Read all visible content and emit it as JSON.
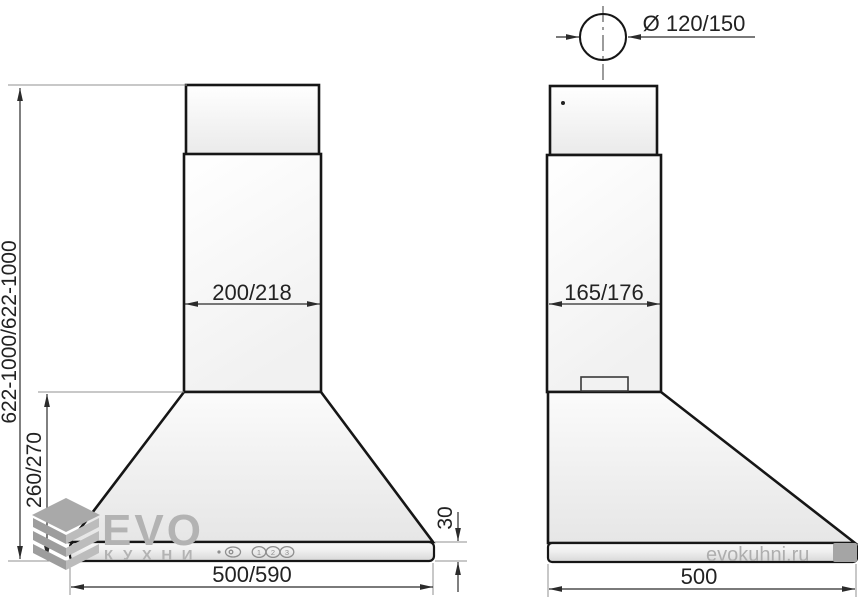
{
  "meta": {
    "type": "technical-installation-drawing",
    "subject": "kitchen chimney cooker hood, front and side views with dimensions"
  },
  "dimensions": {
    "duct_diameter": "Ø 120/150",
    "chimney_width": "200/218",
    "chimney_depth": "165/176",
    "total_height": "622-1000/622-1000",
    "hood_body_height": "260/270",
    "base_width": "500/590",
    "base_depth": "500",
    "bottom_edge_height": "30"
  },
  "controls": {
    "speed1": "1",
    "speed2": "2",
    "speed3": "3"
  },
  "watermark": {
    "brand": "EVO",
    "brand_sub": "КУХНИ",
    "site": "evokuhni.ru"
  },
  "colors": {
    "outline": "#161616",
    "dimension_line": "#2b2b2b",
    "extension_line": "#909090",
    "watermark_gray": "#b3b3b3",
    "fill_light": "#ffffff",
    "fill_shade": "#e6e6e6"
  }
}
